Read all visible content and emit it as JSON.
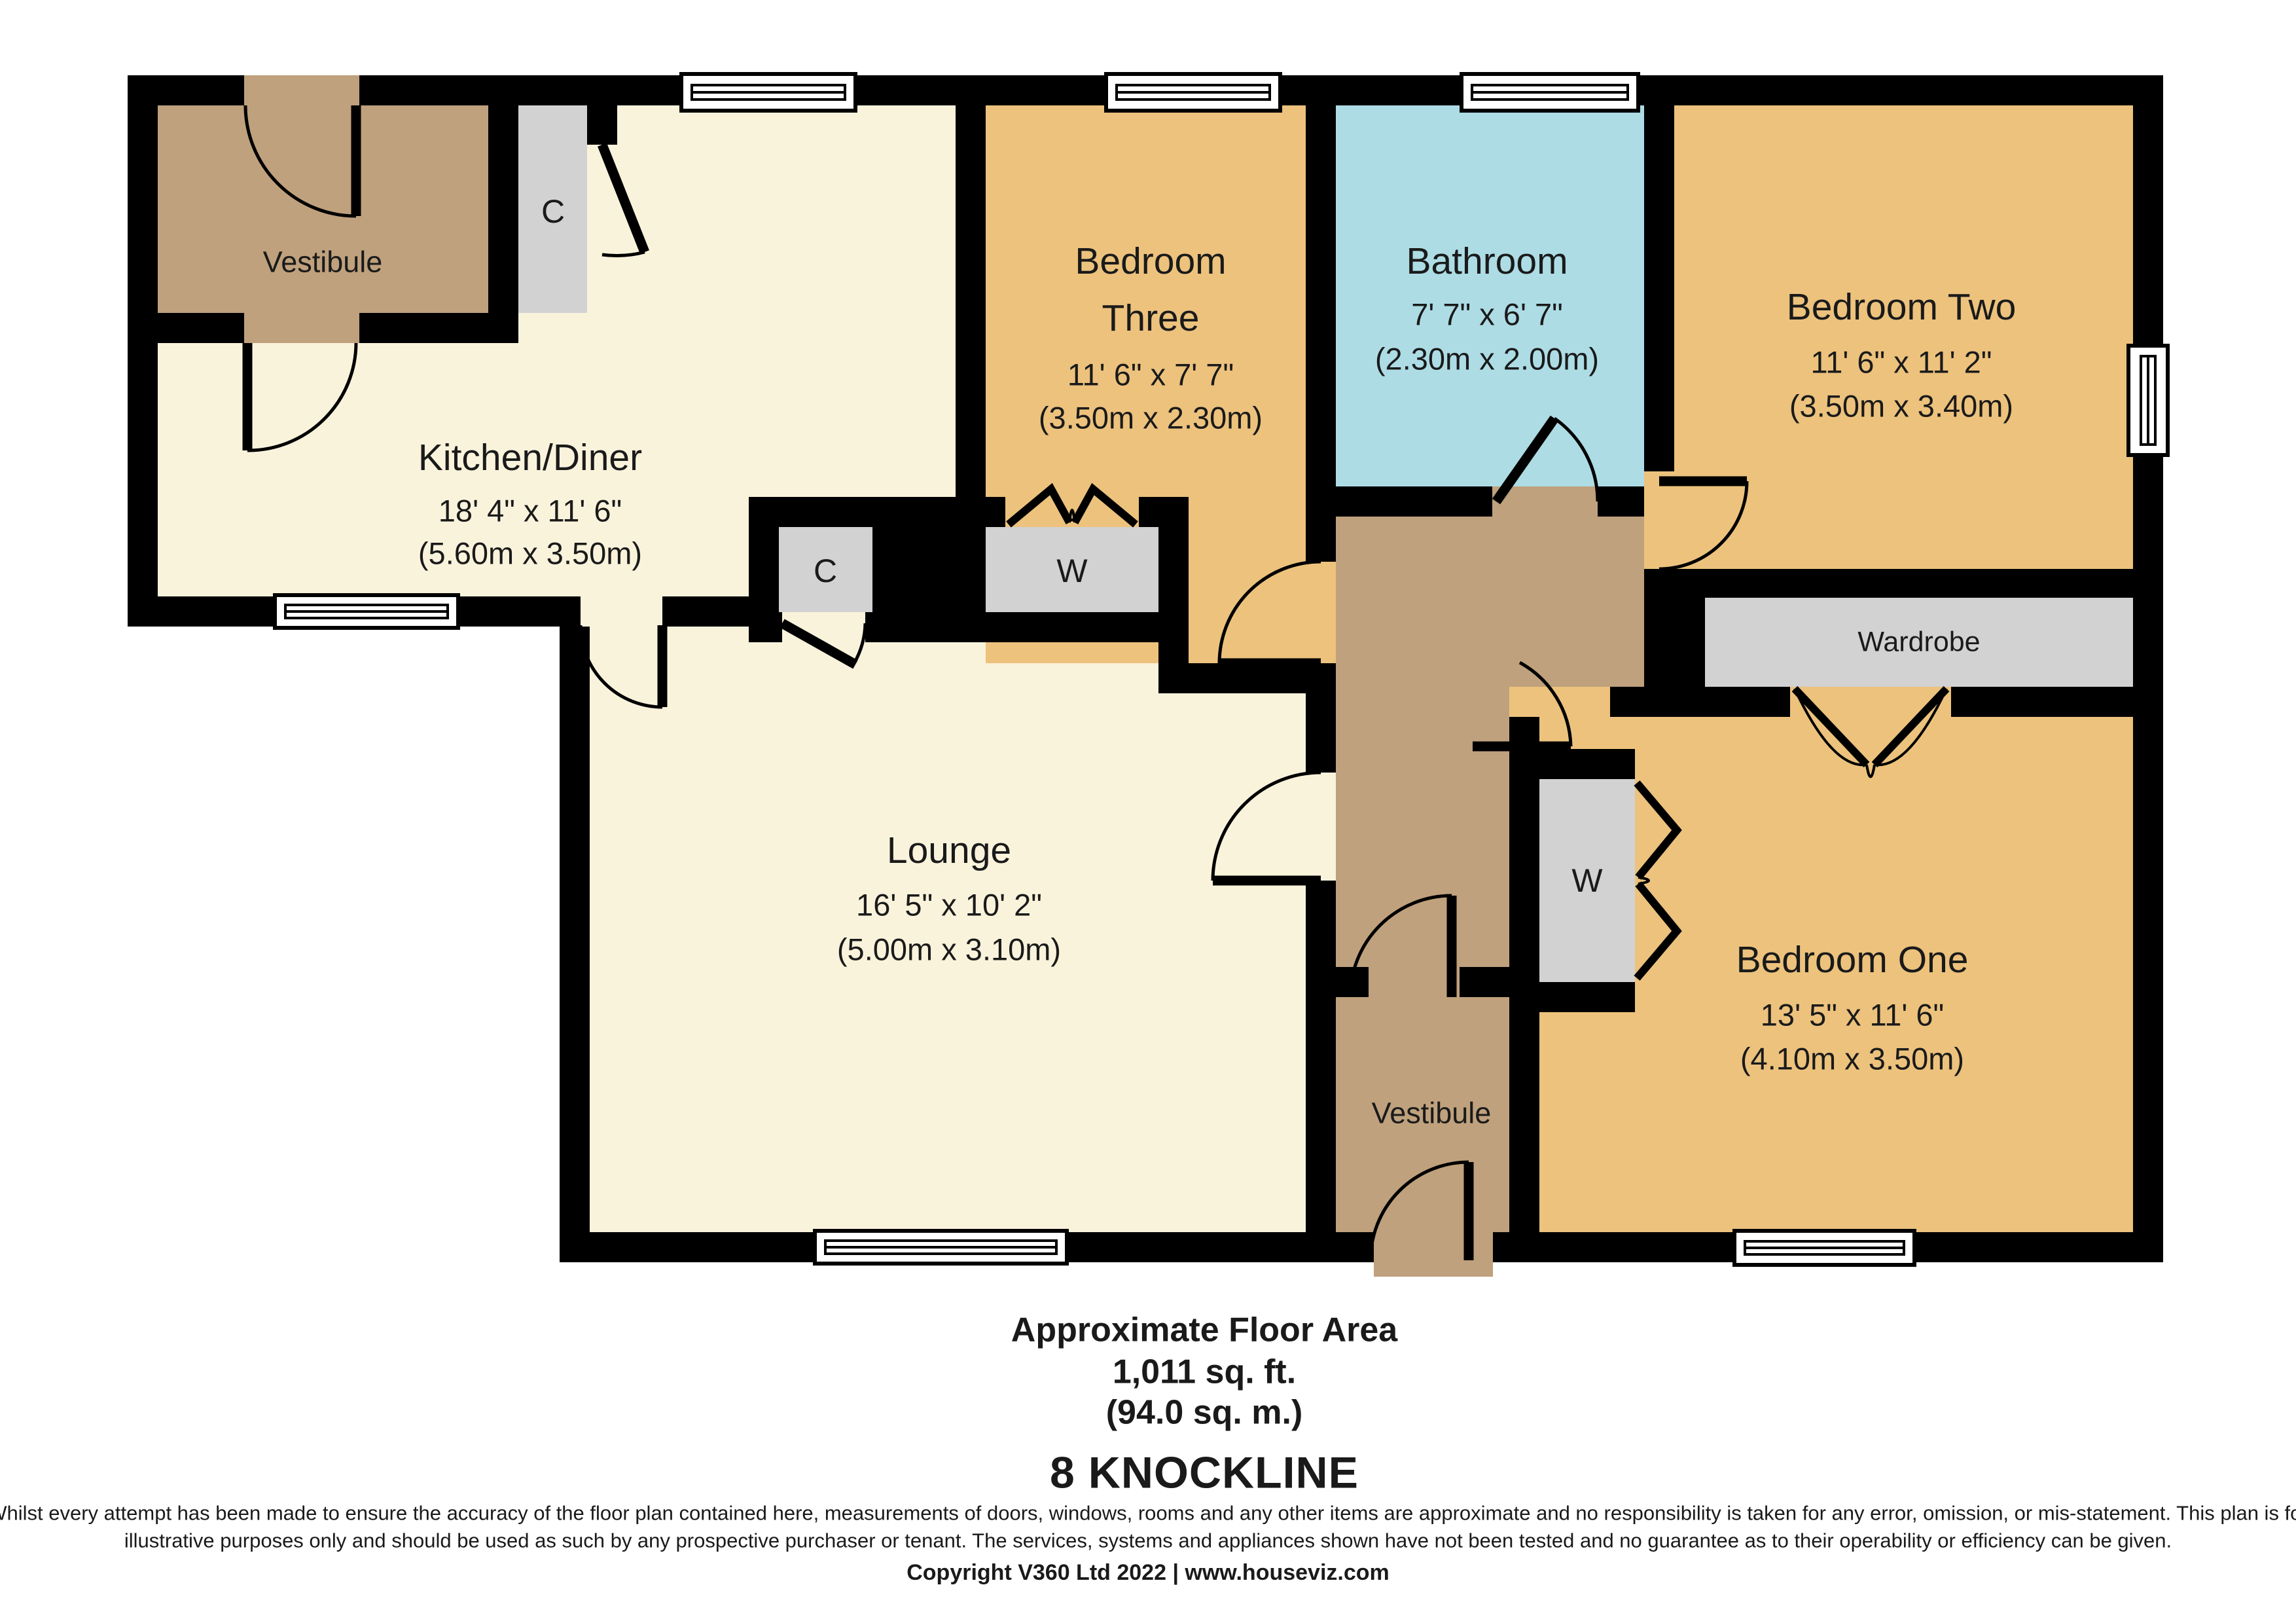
{
  "title": "8 KNOCKLINE",
  "colors": {
    "cream": "#faf3dc",
    "orange": "#ecc27d",
    "tan": "#bfa17d",
    "blue": "#addce5",
    "gray": "#d2d2d2",
    "wall": "#000000",
    "ink": "#1a1a1a",
    "bg": "#ffffff"
  },
  "rooms": {
    "kitchen": {
      "name": "Kitchen/Diner",
      "dim_imperial": "18' 4\" x 11' 6\"",
      "dim_metric": "(5.60m x 3.50m)"
    },
    "lounge": {
      "name": "Lounge",
      "dim_imperial": "16' 5\" x 10' 2\"",
      "dim_metric": "(5.00m x 3.10m)"
    },
    "bedroom_three": {
      "name_line1": "Bedroom",
      "name_line2": "Three",
      "dim_imperial": "11' 6\" x 7' 7\"",
      "dim_metric": "(3.50m x 2.30m)"
    },
    "bathroom": {
      "name": "Bathroom",
      "dim_imperial": "7' 7\" x 6' 7\"",
      "dim_metric": "(2.30m x 2.00m)"
    },
    "bedroom_two": {
      "name": "Bedroom Two",
      "dim_imperial": "11' 6\" x 11' 2\"",
      "dim_metric": "(3.50m x 3.40m)"
    },
    "bedroom_one": {
      "name": "Bedroom One",
      "dim_imperial": "13' 5\" x 11' 6\"",
      "dim_metric": "(4.10m x 3.50m)"
    },
    "vestibule_top": {
      "name": "Vestibule"
    },
    "vestibule_bottom": {
      "name": "Vestibule"
    },
    "wardrobe": {
      "name": "Wardrobe"
    },
    "closet_top": {
      "name": "C"
    },
    "closet_mid": {
      "name": "C"
    },
    "wardrobe_closet_mid": {
      "name": "W"
    },
    "wardrobe_closet_low": {
      "name": "W"
    }
  },
  "footer": {
    "area_label": "Approximate Floor Area",
    "area_sqft": "1,011 sq. ft.",
    "area_sqm": "(94.0 sq. m.)",
    "disclaimer_line1": "Whilst every attempt has been made to ensure the accuracy of the floor plan contained here, measurements of doors, windows, rooms and any other items are approximate and no responsibility is taken for any error, omission, or mis-statement. This plan is for",
    "disclaimer_line2": "illustrative purposes only and should be used as such by any prospective purchaser or tenant. The services, systems and appliances shown have not been tested and no guarantee as to their operability or efficiency can be given.",
    "copyright": "Copyright V360 Ltd 2022 | www.houseviz.com"
  }
}
